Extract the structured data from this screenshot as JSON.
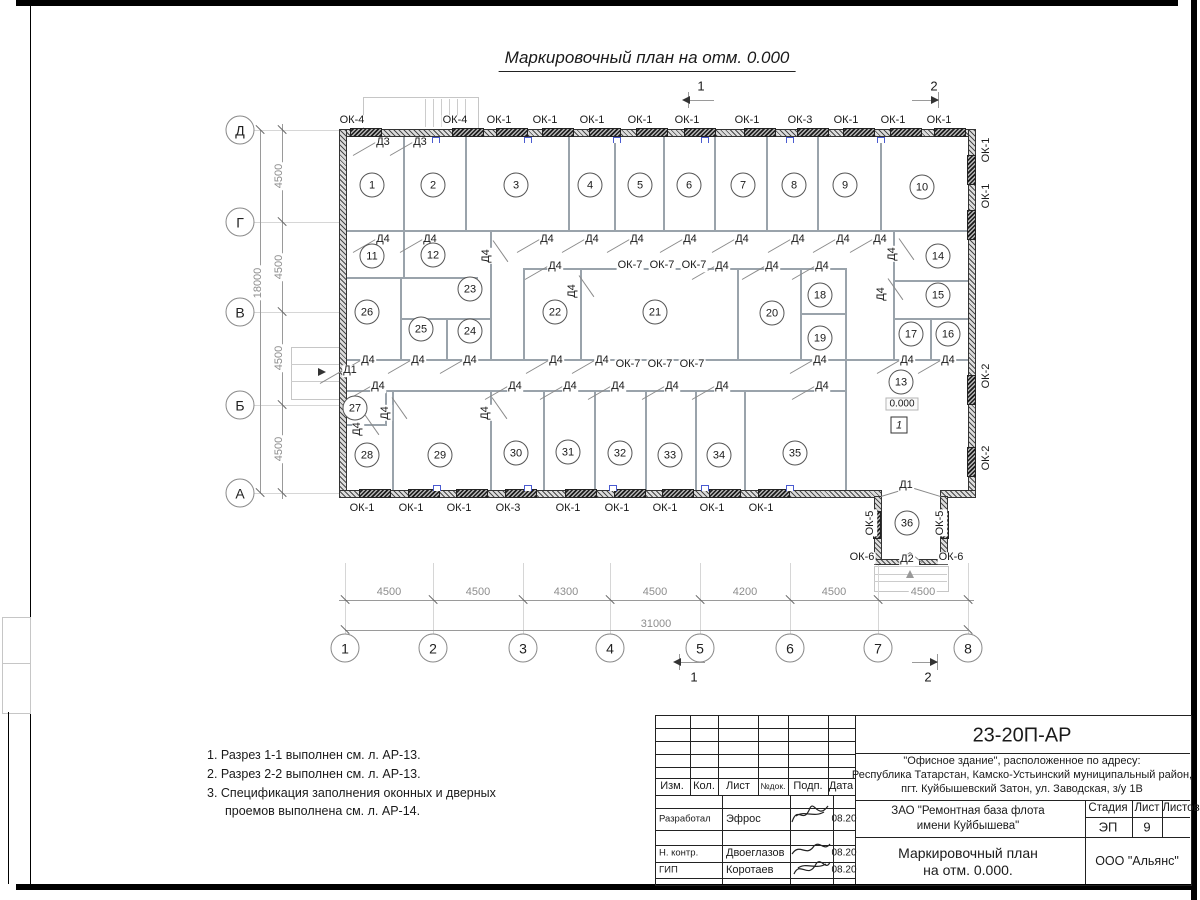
{
  "drawing_title": "Маркировочный план на отм. 0.000",
  "plan": {
    "level_mark": "0.000",
    "floor_mark": "1",
    "rooms": [
      {
        "n": "1",
        "x": 372,
        "y": 185
      },
      {
        "n": "2",
        "x": 433,
        "y": 185
      },
      {
        "n": "3",
        "x": 516,
        "y": 185
      },
      {
        "n": "4",
        "x": 590,
        "y": 185
      },
      {
        "n": "5",
        "x": 640,
        "y": 185
      },
      {
        "n": "6",
        "x": 689,
        "y": 185
      },
      {
        "n": "7",
        "x": 743,
        "y": 185
      },
      {
        "n": "8",
        "x": 794,
        "y": 185
      },
      {
        "n": "9",
        "x": 845,
        "y": 185
      },
      {
        "n": "10",
        "x": 922,
        "y": 187
      },
      {
        "n": "11",
        "x": 372,
        "y": 256
      },
      {
        "n": "12",
        "x": 433,
        "y": 255
      },
      {
        "n": "13",
        "x": 901,
        "y": 382
      },
      {
        "n": "14",
        "x": 938,
        "y": 256
      },
      {
        "n": "15",
        "x": 938,
        "y": 295
      },
      {
        "n": "16",
        "x": 948,
        "y": 334
      },
      {
        "n": "17",
        "x": 911,
        "y": 334
      },
      {
        "n": "18",
        "x": 820,
        "y": 295
      },
      {
        "n": "19",
        "x": 820,
        "y": 338
      },
      {
        "n": "20",
        "x": 772,
        "y": 313
      },
      {
        "n": "21",
        "x": 655,
        "y": 312
      },
      {
        "n": "22",
        "x": 555,
        "y": 312
      },
      {
        "n": "23",
        "x": 470,
        "y": 289
      },
      {
        "n": "24",
        "x": 470,
        "y": 331
      },
      {
        "n": "25",
        "x": 421,
        "y": 329
      },
      {
        "n": "26",
        "x": 367,
        "y": 312
      },
      {
        "n": "27",
        "x": 355,
        "y": 408
      },
      {
        "n": "28",
        "x": 367,
        "y": 455
      },
      {
        "n": "29",
        "x": 440,
        "y": 455
      },
      {
        "n": "30",
        "x": 516,
        "y": 453
      },
      {
        "n": "31",
        "x": 568,
        "y": 452
      },
      {
        "n": "32",
        "x": 620,
        "y": 453
      },
      {
        "n": "33",
        "x": 670,
        "y": 455
      },
      {
        "n": "34",
        "x": 719,
        "y": 455
      },
      {
        "n": "35",
        "x": 795,
        "y": 453
      },
      {
        "n": "36",
        "x": 907,
        "y": 523
      }
    ],
    "labels": [
      {
        "t": "ОК-4",
        "x": 352,
        "y": 121
      },
      {
        "t": "ОК-4",
        "x": 455,
        "y": 121
      },
      {
        "t": "ОК-1",
        "x": 499,
        "y": 121
      },
      {
        "t": "ОК-1",
        "x": 545,
        "y": 121
      },
      {
        "t": "ОК-1",
        "x": 592,
        "y": 121
      },
      {
        "t": "ОК-1",
        "x": 640,
        "y": 121
      },
      {
        "t": "ОК-1",
        "x": 687,
        "y": 121
      },
      {
        "t": "ОК-1",
        "x": 747,
        "y": 121
      },
      {
        "t": "ОК-3",
        "x": 800,
        "y": 121
      },
      {
        "t": "ОК-1",
        "x": 846,
        "y": 121
      },
      {
        "t": "ОК-1",
        "x": 893,
        "y": 121
      },
      {
        "t": "ОК-1",
        "x": 939,
        "y": 121
      },
      {
        "t": "Д3",
        "x": 383,
        "y": 143,
        "d": 1
      },
      {
        "t": "Д3",
        "x": 420,
        "y": 143,
        "d": 1
      },
      {
        "t": "Д4",
        "x": 383,
        "y": 240,
        "d": 1
      },
      {
        "t": "Д4",
        "x": 430,
        "y": 240,
        "d": 1
      },
      {
        "t": "Д4",
        "x": 547,
        "y": 240,
        "d": 1
      },
      {
        "t": "Д4",
        "x": 592,
        "y": 240,
        "d": 1
      },
      {
        "t": "Д4",
        "x": 637,
        "y": 240,
        "d": 1
      },
      {
        "t": "Д4",
        "x": 690,
        "y": 240,
        "d": 1
      },
      {
        "t": "Д4",
        "x": 742,
        "y": 240,
        "d": 1
      },
      {
        "t": "Д4",
        "x": 798,
        "y": 240,
        "d": 1
      },
      {
        "t": "Д4",
        "x": 843,
        "y": 240,
        "d": 1
      },
      {
        "t": "Д4",
        "x": 880,
        "y": 240,
        "d": 1
      },
      {
        "t": "Д4",
        "x": 487,
        "y": 256,
        "r": 1,
        "d": 1
      },
      {
        "t": "Д4",
        "x": 893,
        "y": 254,
        "r": 1,
        "d": 1
      },
      {
        "t": "Д4",
        "x": 555,
        "y": 267,
        "d": 1
      },
      {
        "t": "ОК-7",
        "x": 630,
        "y": 266
      },
      {
        "t": "ОК-7",
        "x": 662,
        "y": 266
      },
      {
        "t": "ОК-7",
        "x": 694,
        "y": 266
      },
      {
        "t": "Д4",
        "x": 722,
        "y": 267,
        "d": 1
      },
      {
        "t": "Д4",
        "x": 772,
        "y": 267,
        "d": 1
      },
      {
        "t": "Д4",
        "x": 822,
        "y": 267,
        "d": 1
      },
      {
        "t": "Д4",
        "x": 573,
        "y": 291,
        "r": 1,
        "d": 1
      },
      {
        "t": "Д4",
        "x": 882,
        "y": 294,
        "r": 1,
        "d": 1
      },
      {
        "t": "Д4",
        "x": 368,
        "y": 361,
        "d": 1
      },
      {
        "t": "Д4",
        "x": 418,
        "y": 361,
        "d": 1
      },
      {
        "t": "Д4",
        "x": 470,
        "y": 361,
        "d": 1
      },
      {
        "t": "Д4",
        "x": 556,
        "y": 361,
        "d": 1
      },
      {
        "t": "Д4",
        "x": 602,
        "y": 361,
        "d": 1
      },
      {
        "t": "ОК-7",
        "x": 628,
        "y": 365
      },
      {
        "t": "ОК-7",
        "x": 660,
        "y": 365
      },
      {
        "t": "ОК-7",
        "x": 692,
        "y": 365
      },
      {
        "t": "Д4",
        "x": 820,
        "y": 361,
        "d": 1
      },
      {
        "t": "Д4",
        "x": 907,
        "y": 361,
        "d": 1
      },
      {
        "t": "Д4",
        "x": 948,
        "y": 361,
        "d": 1
      },
      {
        "t": "Д4",
        "x": 378,
        "y": 387,
        "d": 1
      },
      {
        "t": "Д4",
        "x": 515,
        "y": 387,
        "d": 1
      },
      {
        "t": "Д4",
        "x": 570,
        "y": 387,
        "d": 1
      },
      {
        "t": "Д4",
        "x": 618,
        "y": 387,
        "d": 1
      },
      {
        "t": "Д4",
        "x": 672,
        "y": 387,
        "d": 1
      },
      {
        "t": "Д4",
        "x": 722,
        "y": 387,
        "d": 1
      },
      {
        "t": "Д4",
        "x": 822,
        "y": 387,
        "d": 1
      },
      {
        "t": "Д4",
        "x": 386,
        "y": 413,
        "r": 1,
        "d": 1
      },
      {
        "t": "Д4",
        "x": 486,
        "y": 413,
        "r": 1,
        "d": 1
      },
      {
        "t": "Д4",
        "x": 358,
        "y": 429,
        "r": 1,
        "d": 1
      },
      {
        "t": "Д1",
        "x": 350,
        "y": 371,
        "d": 1
      },
      {
        "t": "Д1",
        "x": 906,
        "y": 486
      },
      {
        "t": "Д2",
        "x": 907,
        "y": 560
      },
      {
        "t": "ОК-1",
        "x": 362,
        "y": 509
      },
      {
        "t": "ОК-1",
        "x": 411,
        "y": 509
      },
      {
        "t": "ОК-1",
        "x": 459,
        "y": 509
      },
      {
        "t": "ОК-3",
        "x": 508,
        "y": 509
      },
      {
        "t": "ОК-1",
        "x": 568,
        "y": 509
      },
      {
        "t": "ОК-1",
        "x": 617,
        "y": 509
      },
      {
        "t": "ОК-1",
        "x": 665,
        "y": 509
      },
      {
        "t": "ОК-1",
        "x": 712,
        "y": 509
      },
      {
        "t": "ОК-1",
        "x": 761,
        "y": 509
      },
      {
        "t": "ОК-1",
        "x": 987,
        "y": 150,
        "r": 1
      },
      {
        "t": "ОК-1",
        "x": 987,
        "y": 196,
        "r": 1
      },
      {
        "t": "ОК-2",
        "x": 987,
        "y": 376,
        "r": 1
      },
      {
        "t": "ОК-2",
        "x": 987,
        "y": 458,
        "r": 1
      },
      {
        "t": "ОК-5",
        "x": 871,
        "y": 523,
        "r": 1
      },
      {
        "t": "ОК-5",
        "x": 941,
        "y": 523,
        "r": 1
      },
      {
        "t": "ОК-6",
        "x": 862,
        "y": 558
      },
      {
        "t": "ОК-6",
        "x": 951,
        "y": 558
      }
    ],
    "axes_cols": [
      {
        "t": "1",
        "x": 345
      },
      {
        "t": "2",
        "x": 433
      },
      {
        "t": "3",
        "x": 523
      },
      {
        "t": "4",
        "x": 610
      },
      {
        "t": "5",
        "x": 700
      },
      {
        "t": "6",
        "x": 790
      },
      {
        "t": "7",
        "x": 878
      },
      {
        "t": "8",
        "x": 968
      }
    ],
    "axes_rows": [
      {
        "t": "Д",
        "y": 130
      },
      {
        "t": "Г",
        "y": 222
      },
      {
        "t": "В",
        "y": 312
      },
      {
        "t": "Б",
        "y": 405
      },
      {
        "t": "А",
        "y": 493
      }
    ],
    "dims_bottom": [
      {
        "t": "4500",
        "x": 389
      },
      {
        "t": "4500",
        "x": 478
      },
      {
        "t": "4300",
        "x": 566
      },
      {
        "t": "4500",
        "x": 655
      },
      {
        "t": "4200",
        "x": 745
      },
      {
        "t": "4500",
        "x": 834
      },
      {
        "t": "4500",
        "x": 923
      }
    ],
    "dim_total_bottom": {
      "t": "31000",
      "x": 656,
      "y": 624
    },
    "dims_left": [
      {
        "t": "4500",
        "y": 176
      },
      {
        "t": "4500",
        "y": 267
      },
      {
        "t": "4500",
        "y": 358
      },
      {
        "t": "4500",
        "y": 449
      }
    ],
    "dim_total_left": {
      "t": "18000",
      "x": 258,
      "y": 283
    },
    "section_marks": [
      {
        "t": "1",
        "x": 701,
        "y": 86
      },
      {
        "t": "2",
        "x": 934,
        "y": 86
      },
      {
        "t": "1",
        "x": 694,
        "y": 677
      },
      {
        "t": "2",
        "x": 928,
        "y": 677
      }
    ]
  },
  "notes": [
    "1. Разрез 1-1 выполнен см. л. АР-13.",
    "2. Разрез 2-2 выполнен см. л. АР-13.",
    "3. Спецификация заполнения оконных и дверных проемов выполнена см. л. АР-14."
  ],
  "titleblock": {
    "doc_code": "23-20П-АР",
    "address_lines": [
      "\"Офисное здание\", расположенное по адресу:",
      "Республика Татарстан, Камско-Устьинский муниципальный район,",
      "пгт. Куйбышевский Затон, ул. Заводская, з/у 1В"
    ],
    "cols": [
      "Изм.",
      "Кол.",
      "Лист",
      "№док.",
      "Подп.",
      "Дата"
    ],
    "rows": [
      {
        "role": "Разработал",
        "name": "Эфрос",
        "date": "08.20"
      },
      {
        "role": "Н. контр.",
        "name": "Двоеглазов",
        "date": "08.20"
      },
      {
        "role": "ГИП",
        "name": "Коротаев",
        "date": "08.20"
      }
    ],
    "client_line1": "ЗАО \"Ремонтная база флота",
    "client_line2": "имени Куйбышева\"",
    "stage_label": "Стадия",
    "sheet_label": "Лист",
    "sheets_label": "Листов",
    "stage": "ЭП",
    "sheet": "9",
    "sheet_title_line1": "Маркировочный план",
    "sheet_title_line2": "на отм. 0.000.",
    "company": "ООО \"Альянс\""
  }
}
